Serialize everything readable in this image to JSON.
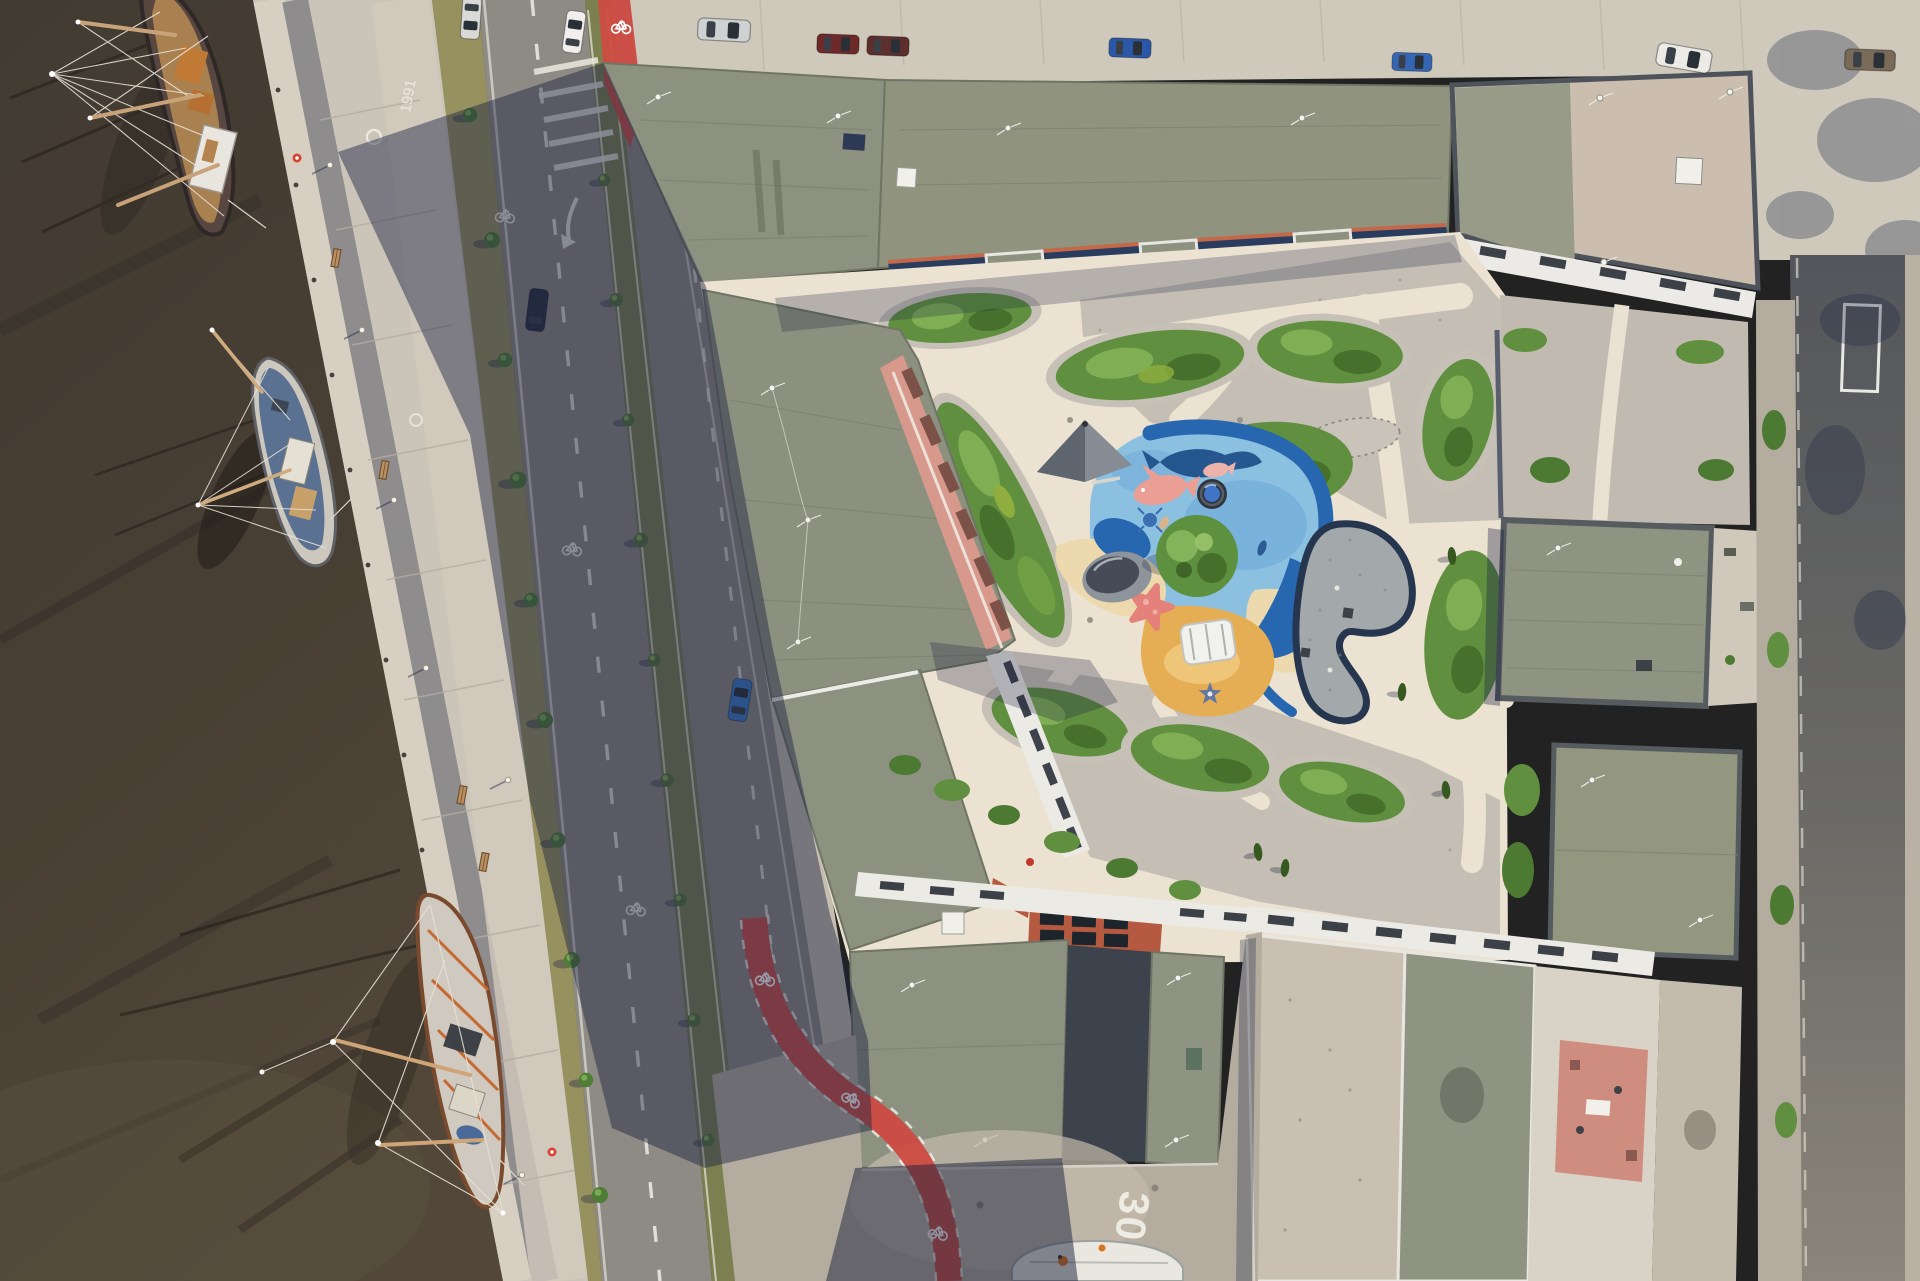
{
  "meta": {
    "title": "Aerial drone photograph, top-down view of a waterfront residential quarter with moored sailing ships, a tree-lined boulevard and an ocean-themed playground courtyard"
  },
  "markings": {
    "speed_limit": "30",
    "quay_inscription": "1991"
  },
  "palette": {
    "water": "#463f35",
    "quay_cobble": "#cbc5b9",
    "granite_band": "#908d8e",
    "asphalt": "#8e8a84",
    "shadow": "rgba(28,34,66,0.46)",
    "grass_median": "#7c8050",
    "bike_lane_red": "#cf4b42",
    "roof_olive": "#8d9180",
    "roof_gravel_pink": "#ccbeae",
    "facade_pink": "#d7998b",
    "solar_panel_blue": "#2b3d5f",
    "solar_roof_red": "#b55a41",
    "path_cream": "#ebe2d1",
    "courtyard_gravel": "#c4beb4",
    "shrub_green": "#5f8f3f",
    "play_light_blue": "#8cc0e1",
    "play_deep_blue": "#2767b0",
    "play_sand": "#ecd9ae",
    "play_orange": "#e6ae54",
    "starfish_pink": "#e4817a"
  },
  "water_area": {
    "label": "harbor basin",
    "ships": [
      {
        "id": "ship-top",
        "type": "tall sailing ship",
        "hull": "dark brown",
        "deck": "orange-brown with white cabin"
      },
      {
        "id": "ship-middle",
        "type": "sailing yacht",
        "deck": "blue with wooden cabin"
      },
      {
        "id": "ship-bottom",
        "type": "tall sailing ship",
        "hull": "rust orange frames, white deck"
      }
    ]
  },
  "boulevard": {
    "lanes": 2,
    "median": "grass strip with young trees and lampposts",
    "markings": [
      "dashed lane lines",
      "bicycle pictograms",
      "white hatching",
      "turn arrow"
    ],
    "cars": [
      {
        "color": "silver",
        "position": "top, northbound"
      },
      {
        "color": "white",
        "position": "top, southbound"
      },
      {
        "color": "dark navy",
        "position": "upper middle"
      },
      {
        "color": "blue",
        "position": "lower middle"
      }
    ]
  },
  "top_street": {
    "parked_vehicles": [
      "silver van",
      "dark red car",
      "maroon car",
      "blue car",
      "blue car",
      "white van",
      "brown van"
    ]
  },
  "south_street": {
    "speed_marking": "30",
    "features": [
      "red bicycle crossing",
      "white rowing boat",
      "pedestrian in orange"
    ]
  },
  "right_street": {
    "features": [
      "white parking bay marking",
      "tree shadows"
    ]
  },
  "courtyard": {
    "ground": "cream concrete paths with grey gravel mulch",
    "planting": "kidney-shaped shrub beds, columnar cypresses, one large round tree",
    "playground": {
      "theme": "ocean",
      "features": [
        "light blue rubber sea",
        "deep blue ribbon",
        "pink fish",
        "small pink fish",
        "whale silhouette",
        "in-ground trampoline",
        "pink starfish",
        "sand-coloured beach",
        "orange play hill with white climbing frame",
        "blue rope net star",
        "grey pyramid climber",
        "dark rubber mound",
        "kidney-shaped gravel pad with dark edging"
      ]
    }
  },
  "buildings": {
    "roofs": [
      "olive-green flat roofs",
      "pink gravel ballast roof",
      "red-brown roof with black solar panels",
      "graphite shaded sections"
    ],
    "facades": [
      "salmon-pink band with window slots",
      "white stacked balconies",
      "orange frames with dark blue solar collectors",
      "pink roof terrace with table"
    ]
  }
}
